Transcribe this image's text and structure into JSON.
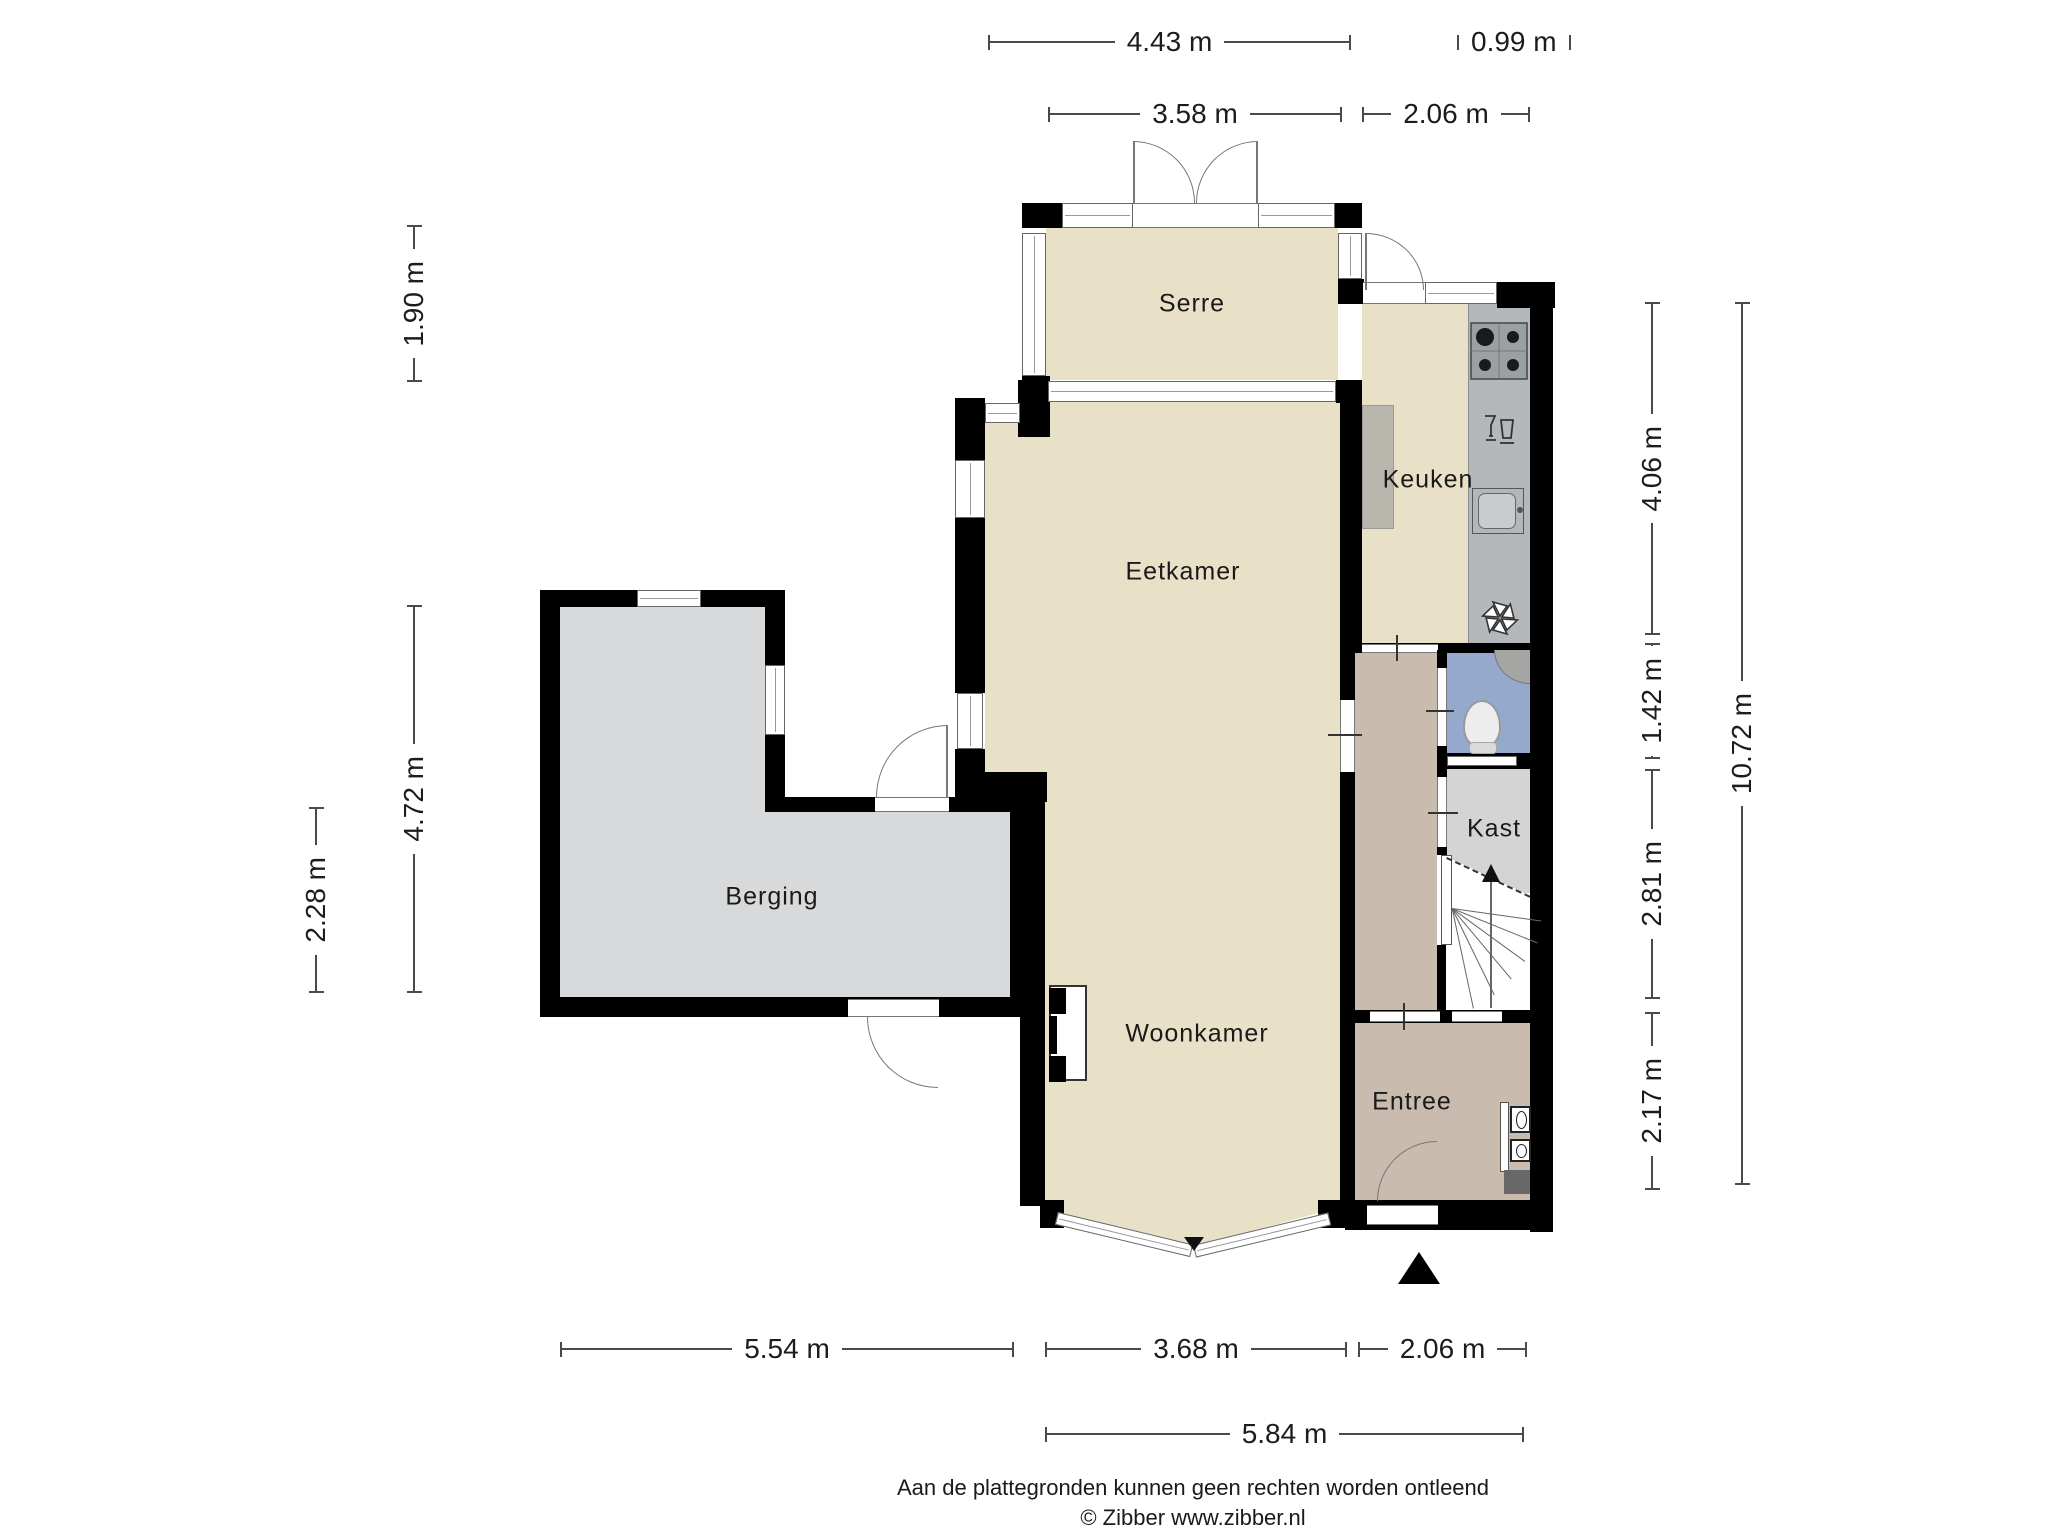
{
  "plan_type": "floor-plan-ground-floor",
  "palette": {
    "wall": "#000000",
    "floor_living": "#e9e0c8",
    "floor_storage": "#d8d9da",
    "floor_hall": "#c9bcae",
    "floor_toilet": "#94a9cc",
    "floor_closet": "#d4d4d4",
    "counter": "#b4b8ba",
    "dimension_line": "#4a4a4a"
  },
  "rooms": {
    "serre": "Serre",
    "keuken": "Keuken",
    "eetkamer": "Eetkamer",
    "berging": "Berging",
    "kast": "Kast",
    "woonkamer": "Woonkamer",
    "entree": "Entree"
  },
  "dims": {
    "top_443": "4.43 m",
    "top_099": "0.99 m",
    "top_358": "3.58 m",
    "top_206": "2.06 m",
    "left_190": "1.90 m",
    "left_472": "4.72 m",
    "left_228": "2.28 m",
    "right_406": "4.06 m",
    "right_142": "1.42 m",
    "right_281": "2.81 m",
    "right_217": "2.17 m",
    "right_1072": "10.72 m",
    "bottom_554": "5.54 m",
    "bottom_368": "3.68 m",
    "bottom_206": "2.06 m",
    "bottom_584": "5.84 m"
  },
  "footer": {
    "disclaimer": "Aan de plattegronden kunnen geen rechten worden ontleend",
    "copyright": "© Zibber www.zibber.nl"
  }
}
